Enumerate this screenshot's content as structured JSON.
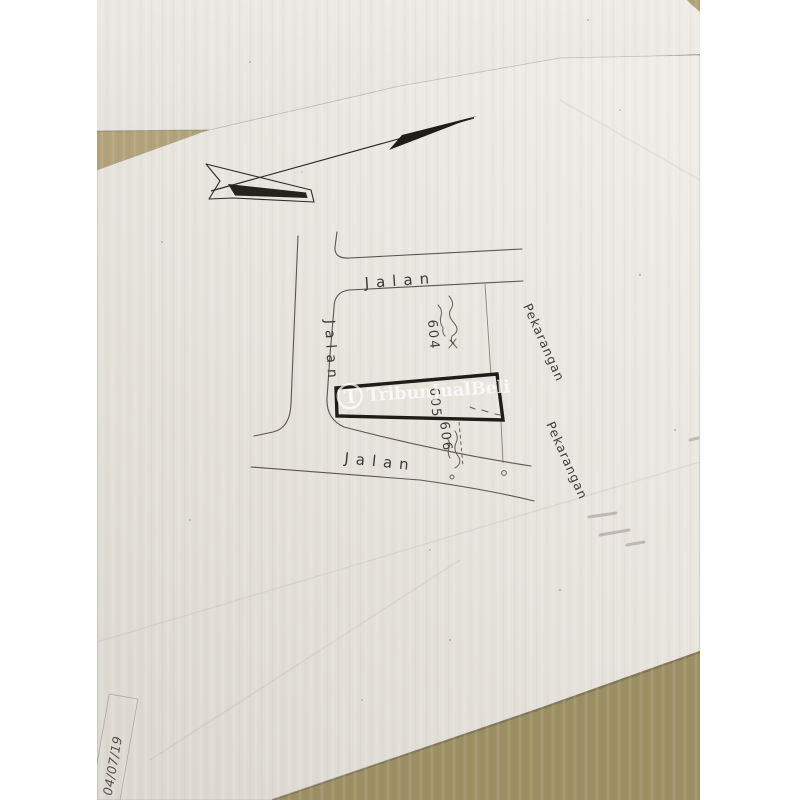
{
  "photo": {
    "watermark": {
      "logo_initial": "T",
      "text": "TribunJualBeli"
    },
    "map": {
      "icons": {
        "north_arrow": "north-arrow"
      },
      "road_labels": {
        "top": "Jalan",
        "left": "Jalan",
        "bottom": "Jalan"
      },
      "plot_numbers": {
        "p604": "604",
        "p605": "605",
        "p606": "606"
      },
      "area_labels": {
        "right_upper": "Pekarangan",
        "right_lower": "Pekarangan"
      }
    },
    "handwriting": {
      "date_note": "04/07/19"
    },
    "colors": {
      "margin": "#ffffff",
      "desk": "#a89a6e",
      "back_sheet": "#eae7e2",
      "paper": "#e7e4de",
      "ink": "#55504a",
      "bold_plot_outline": "#1f1d1a",
      "watermark": "#ffffff"
    }
  }
}
